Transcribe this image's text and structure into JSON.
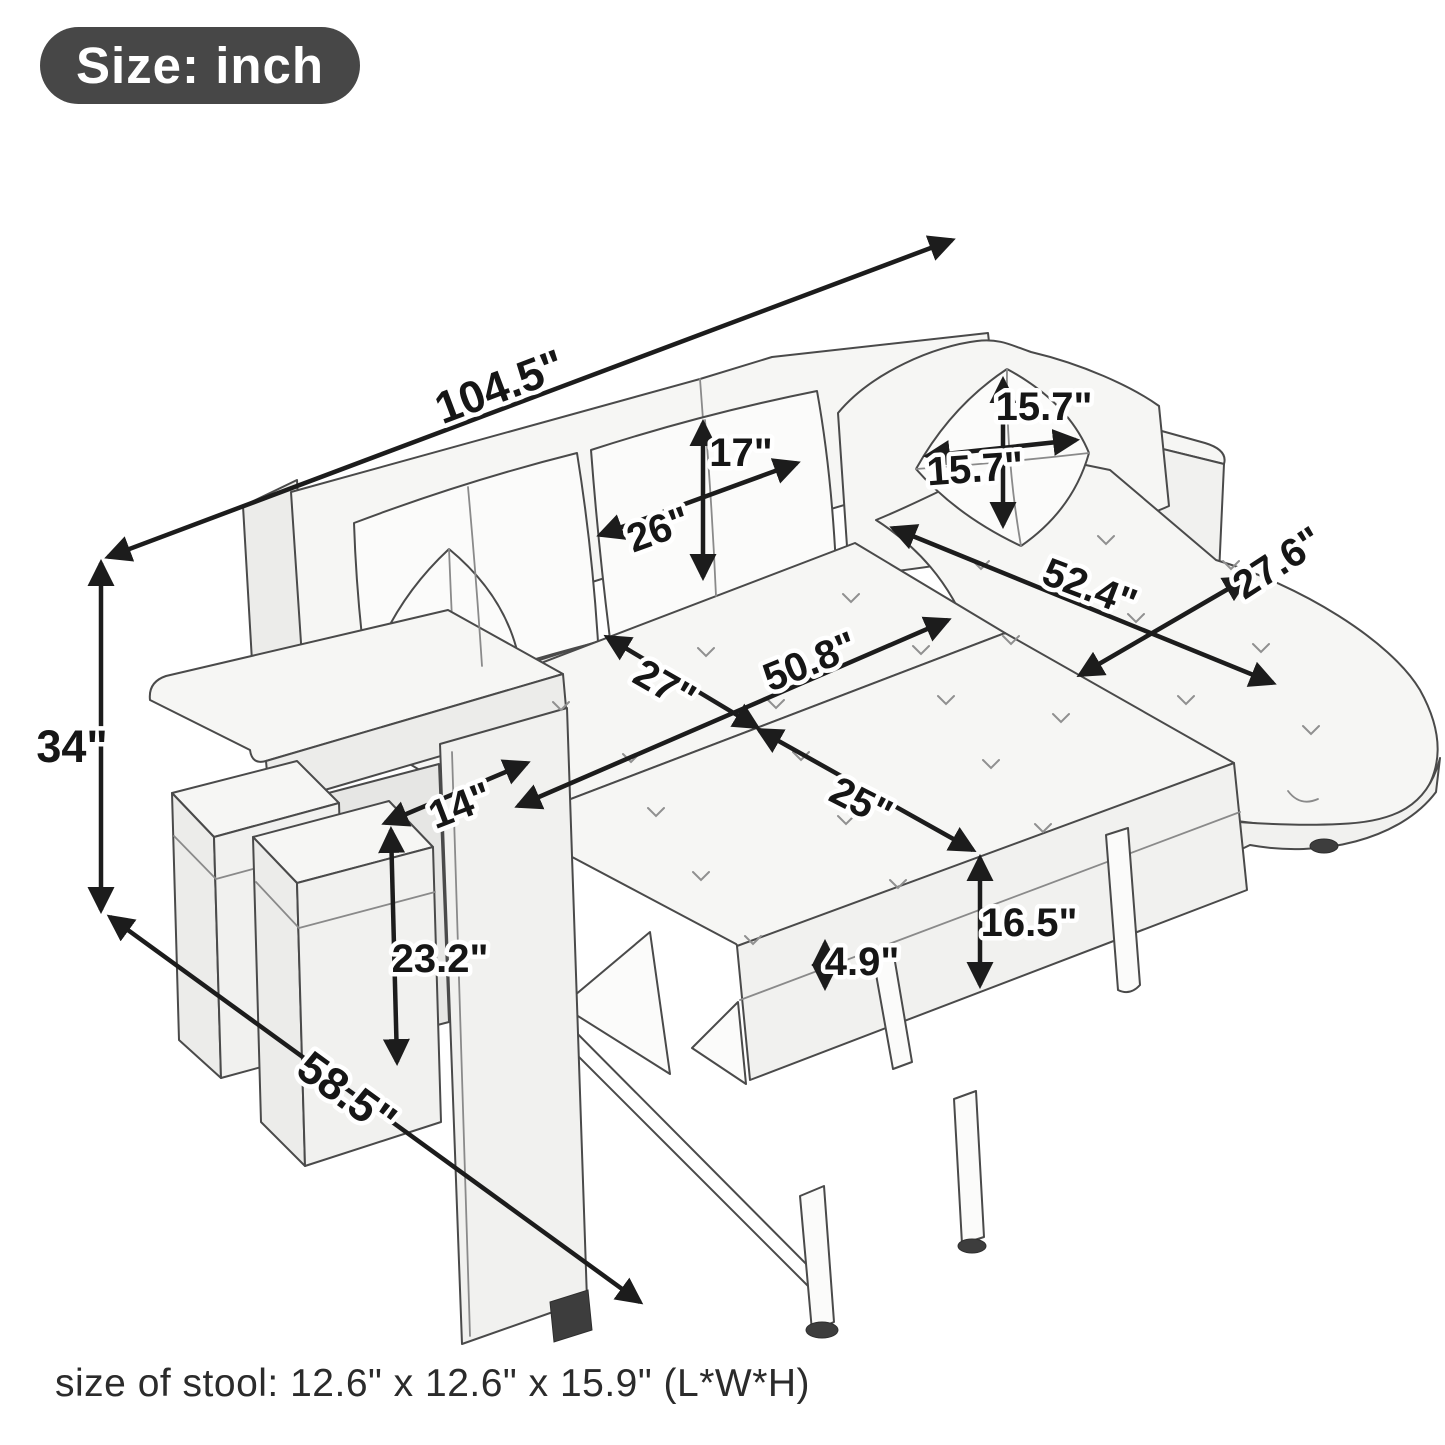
{
  "badge": {
    "label": "Size: inch"
  },
  "unit": "inch",
  "dimensions": [
    {
      "id": "overall-width",
      "part": "sofa overall width",
      "label": "104.5\""
    },
    {
      "id": "overall-height",
      "part": "sofa overall height",
      "label": "34\""
    },
    {
      "id": "overall-depth",
      "part": "sofa overall depth",
      "label": "58.5\""
    },
    {
      "id": "back-cushion-height",
      "part": "back cushion height",
      "label": "17\""
    },
    {
      "id": "back-cushion-width",
      "part": "back cushion width",
      "label": "26\""
    },
    {
      "id": "pillow-height",
      "part": "throw pillow height",
      "label": "15.7\""
    },
    {
      "id": "pillow-width",
      "part": "throw pillow width",
      "label": "15.7\""
    },
    {
      "id": "chaise-length",
      "part": "chaise length",
      "label": "52.4\""
    },
    {
      "id": "chaise-width",
      "part": "chaise width",
      "label": "27.6\""
    },
    {
      "id": "seat-depth",
      "part": "seat depth",
      "label": "27\""
    },
    {
      "id": "bed-width",
      "part": "pull-out bed width",
      "label": "50.8\""
    },
    {
      "id": "pullout-depth",
      "part": "pull-out section depth",
      "label": "25\""
    },
    {
      "id": "arm-width",
      "part": "armrest width",
      "label": "14\""
    },
    {
      "id": "arm-height",
      "part": "armrest side height",
      "label": "23.2\""
    },
    {
      "id": "bed-height",
      "part": "pull-out bed height",
      "label": "16.5\""
    },
    {
      "id": "mattress-thickness",
      "part": "mattress thickness",
      "label": "4.9\""
    }
  ],
  "footer": {
    "stool_note": "size of stool: 12.6\" x 12.6\" x 15.9\" (L*W*H)"
  }
}
